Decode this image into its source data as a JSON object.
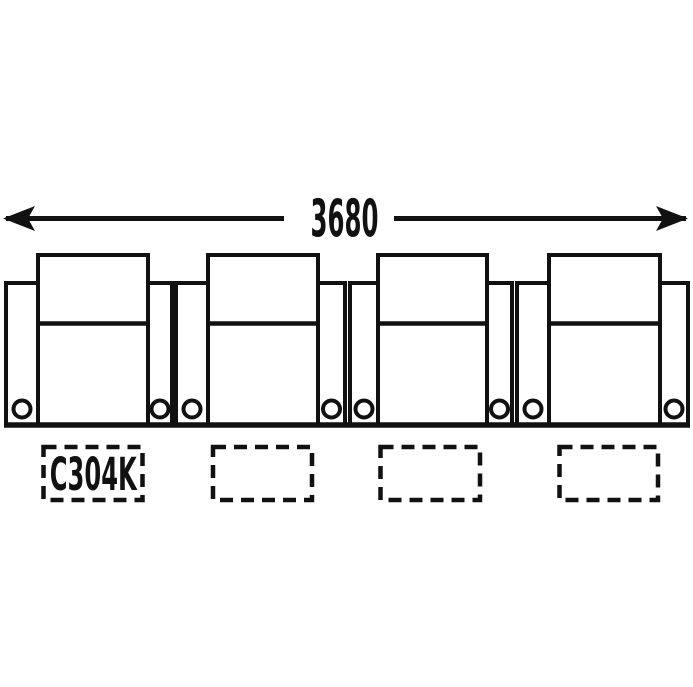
{
  "dimension_label": "3680",
  "row": {
    "seat_count": 4
  },
  "label_slots": [
    {
      "label": "C304K",
      "highlighted": true
    },
    {
      "label": "",
      "highlighted": false
    },
    {
      "label": "",
      "highlighted": false
    },
    {
      "label": "",
      "highlighted": false
    }
  ],
  "icons": {
    "cupholder": "circle"
  },
  "colors": {
    "line": "#111111",
    "highlight": "#FFEE00",
    "background": "#FFFFFF"
  }
}
